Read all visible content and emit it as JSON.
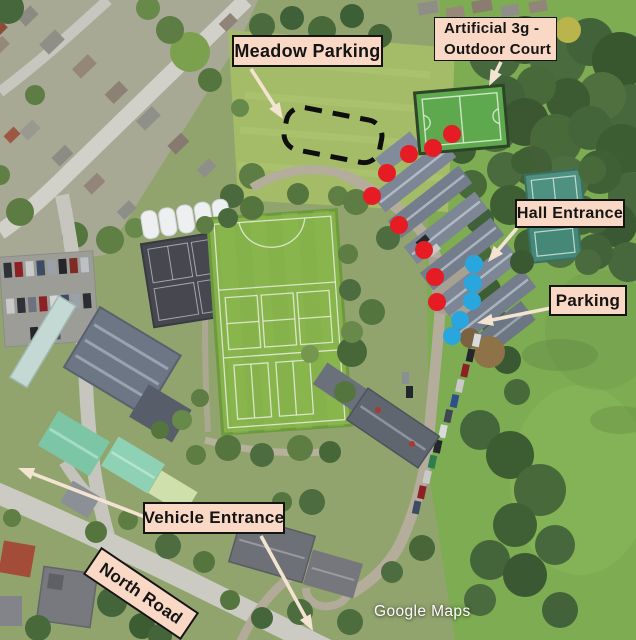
{
  "map": {
    "attribution": "Google Maps",
    "labels": {
      "meadow_parking": "Meadow Parking",
      "artificial_3g_line1": "Artificial 3g -",
      "artificial_3g_line2": "Outdoor Court",
      "hall_entrance": "Hall Entrance",
      "parking": "Parking",
      "vehicle_entrance": "Vehicle Entrance",
      "north_road": "North Road"
    },
    "colors": {
      "label_bg": "#f9d8c5",
      "label_border": "#141414",
      "route_dot_red": "#e61c24",
      "parking_dot_blue": "#2aa6de",
      "arrow": "#f3e3d1",
      "dashed_zone": "#0e0e0e"
    },
    "overlay": {
      "dot_radius": 9,
      "red_dots": [
        [
          452,
          134
        ],
        [
          433,
          148
        ],
        [
          409,
          154
        ],
        [
          387,
          173
        ],
        [
          372,
          196
        ],
        [
          399,
          225
        ],
        [
          424,
          250
        ],
        [
          435,
          277
        ],
        [
          437,
          302
        ]
      ],
      "blue_dots": [
        [
          474,
          264
        ],
        [
          473,
          283
        ],
        [
          472,
          301
        ],
        [
          460,
          320
        ],
        [
          452,
          336
        ]
      ],
      "arrows": [
        {
          "name": "meadow-parking-arrow",
          "from": [
            251,
            69
          ],
          "to": [
            283,
            119
          ]
        },
        {
          "name": "artificial-3g-arrow",
          "from": [
            501,
            62
          ],
          "to": [
            489,
            86
          ]
        },
        {
          "name": "hall-entrance-arrow",
          "from": [
            517,
            228
          ],
          "to": [
            488,
            262
          ]
        },
        {
          "name": "parking-arrow",
          "from": [
            556,
            307
          ],
          "to": [
            477,
            323
          ]
        },
        {
          "name": "vehicle-entrance-west-arrow",
          "from": [
            145,
            517
          ],
          "to": [
            18,
            468
          ]
        },
        {
          "name": "vehicle-entrance-south-arrow",
          "from": [
            261,
            536
          ],
          "to": [
            313,
            631
          ]
        }
      ],
      "dashed_zone": {
        "cx": 333,
        "cy": 135,
        "width": 97,
        "height": 43,
        "rotation": 11
      }
    }
  }
}
